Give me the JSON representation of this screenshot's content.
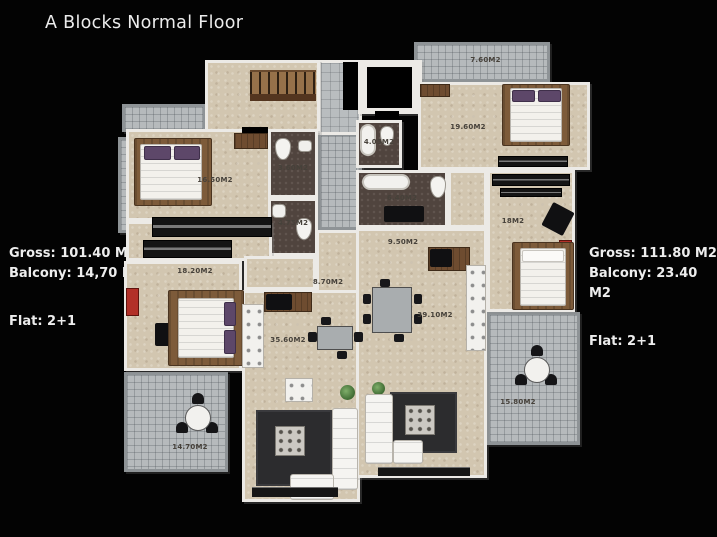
{
  "title": "A Blocks Normal Floor",
  "left_info": {
    "gross": "Gross: 101.40 M2",
    "balcony": "Balcony: 14,70 M2",
    "flat": "Flat: 2+1"
  },
  "right_info": {
    "gross": "Gross: 111.80 M2",
    "balcony": "Balcony: 23.40 M2",
    "flat": "Flat: 2+1"
  },
  "rooms": {
    "left_bedroom1": "16.50M2",
    "left_bath1": "3.60M2",
    "left_bath2": "4.75M2",
    "left_bedroom2": "18.20M2",
    "left_hall": "8.70M2",
    "left_living": "35.60M2",
    "left_balcony": "14.70M2",
    "right_balcony_top": "7.60M2",
    "right_bedroom1": "19.60M2",
    "right_bath1": "4.05M2",
    "right_bath2": "6.40M2",
    "right_hall": "9.50M2",
    "right_bedroom2": "18M2",
    "right_living": "39.10M2",
    "right_balcony": "15.80M2"
  },
  "palette": {
    "background": "#030303",
    "wall": "#eceae6",
    "floor_beige": "#d2c6b0",
    "balcony_gray": "#b6babc",
    "bathroom_brown": "#50443e",
    "wood": "#7d5b3a",
    "rug_dark": "#2c2c2e",
    "accent_red": "#b23028",
    "pillow_purple": "#5d4769"
  }
}
